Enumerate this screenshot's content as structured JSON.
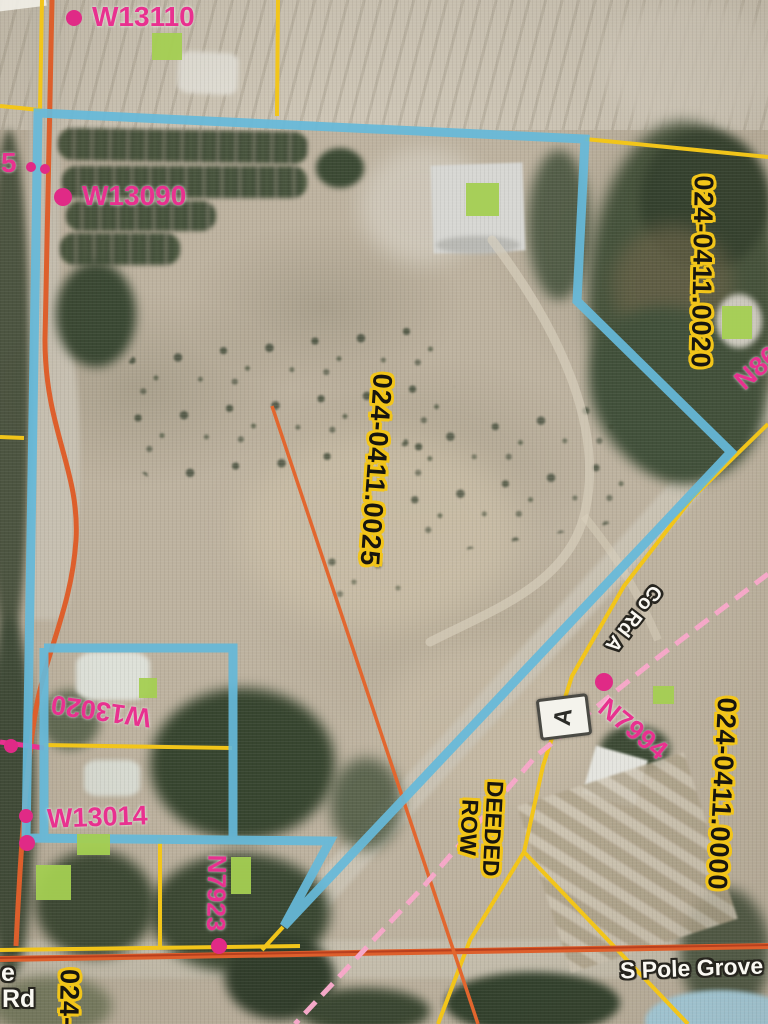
{
  "map": {
    "parcels": {
      "p0025": "024-0411.0025",
      "p0020": "024-0411.0020",
      "p0000": "024-0411.0000",
      "p_partial": "024-0"
    },
    "addresses": {
      "w13110": "W13110",
      "w13090": "W13090",
      "w13020": "W13020",
      "w13014": "W13014",
      "n7923": "N7923",
      "n7994": "N7994",
      "n86_partial": "N86",
      "left_partial": "5"
    },
    "roads": {
      "co_rd_a": "Co Rd A",
      "s_pole_grove": "S Pole Grove",
      "fragment_top": "e",
      "fragment_bottom": "Rd",
      "county_marker": "A"
    },
    "notes": {
      "row_line1": "DEEDED",
      "row_line2": "ROW"
    },
    "colors": {
      "boundary_highlight": "#66b9d9",
      "parcel_line": "#f2c51a",
      "road_line": "#dd5f2c",
      "railroad_line": "#f5a8c8",
      "address_label": "#e8318f",
      "building_marker": "#a4cf52",
      "point_marker": "#e02a86"
    }
  }
}
